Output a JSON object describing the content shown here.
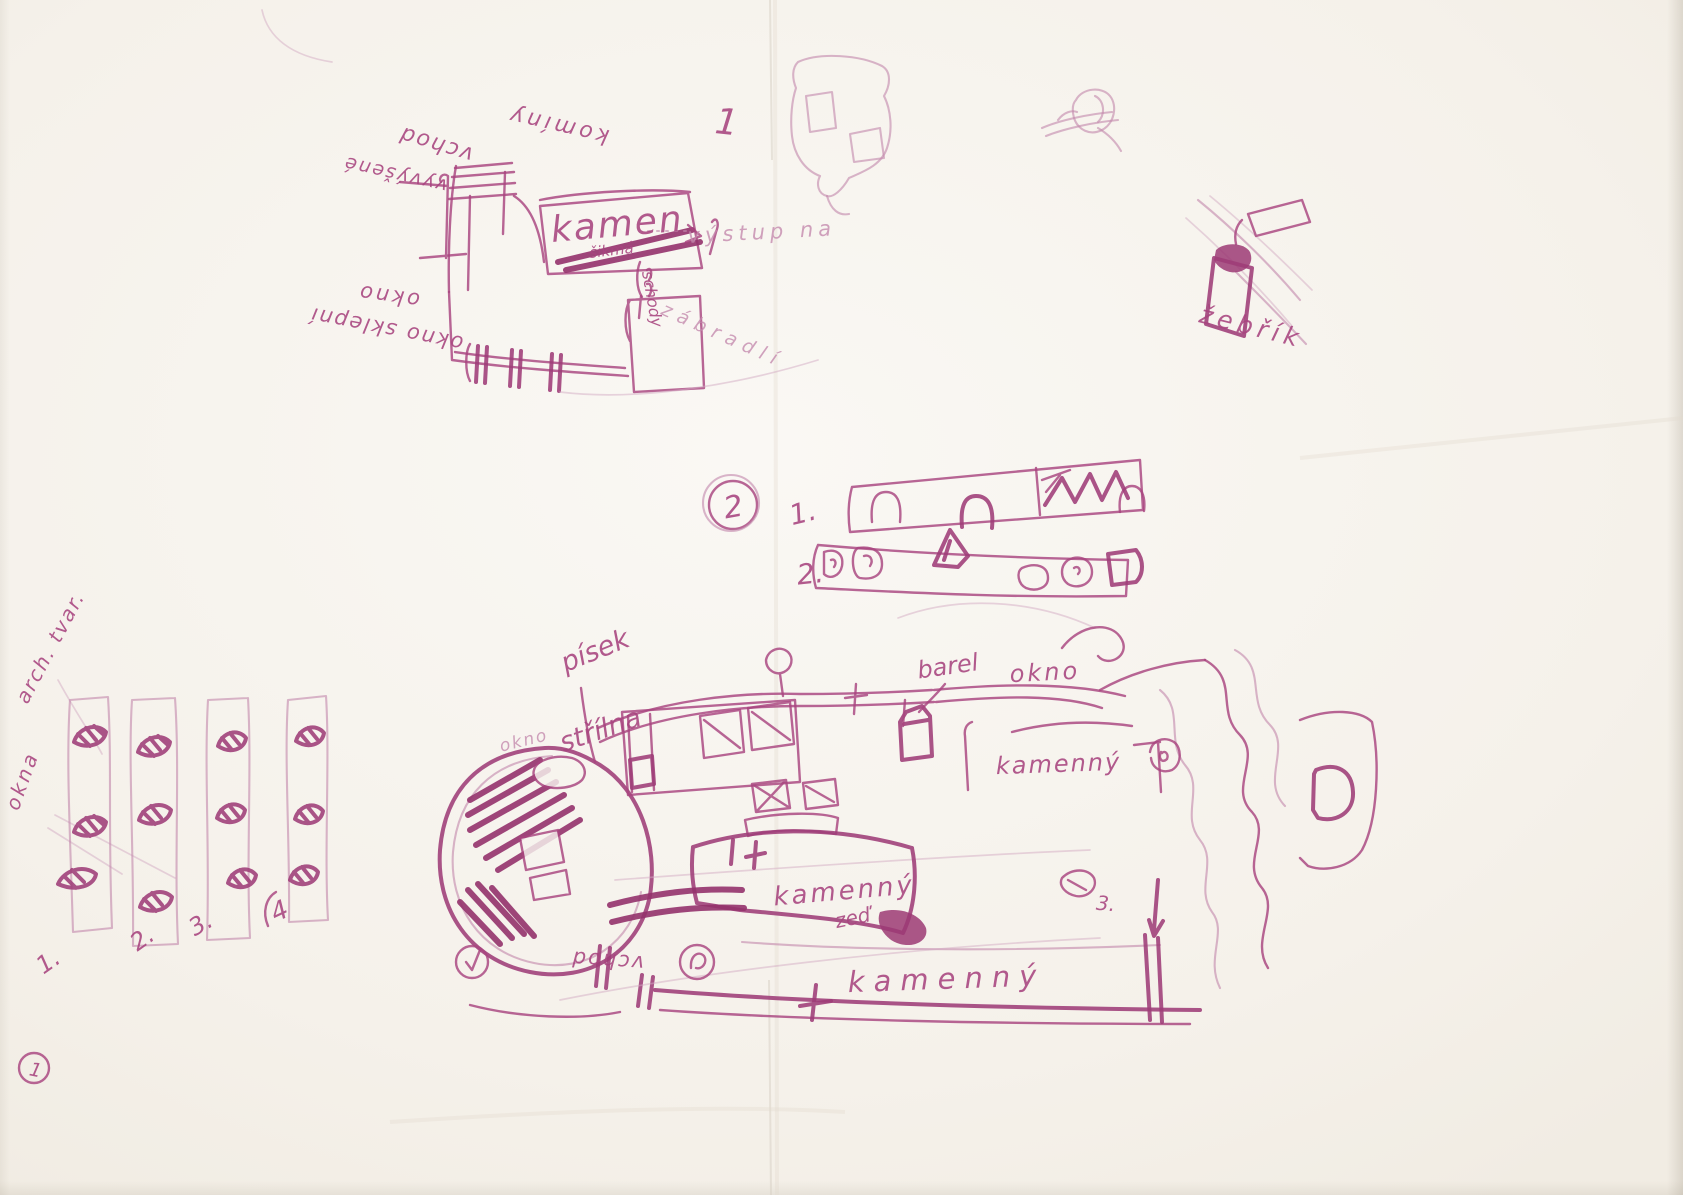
{
  "paper": {
    "background_color": "#f6f3ee",
    "ink_color": "#a8447f"
  },
  "sketch_elevation": {
    "number": "1",
    "labels": {
      "kominy": "komíny",
      "vchod": "vchod",
      "vyvysene": "vyvýšené",
      "okno": "okno",
      "okno_sklepni": "okno sklepní",
      "kamen": "kamen",
      "sikma": "šikmá",
      "vystup": "výstup na",
      "schody": "schody",
      "zabradli": "zábradlí"
    }
  },
  "ladder_sketch": {
    "label": "žebřík"
  },
  "section_profiles": {
    "number": "2",
    "row_numbers": [
      "1.",
      "2."
    ]
  },
  "windows_study": {
    "heading": "arch. tvar.",
    "side_label": "okna",
    "numbers": [
      "1.",
      "2.",
      "3.",
      "4"
    ]
  },
  "plan": {
    "labels": {
      "pisek": "písek",
      "strilna": "střílna",
      "okno_left": "okno",
      "barel": "barel",
      "okno_top": "okno",
      "kamenny_room": "kamenný",
      "kamenna_zed_line1": "kamenný",
      "kamenna_zed_line2": "zeď",
      "kamenny_wall": "kamenný",
      "vchod": "vchod",
      "marker_3": "3."
    }
  },
  "page_marker": "1"
}
